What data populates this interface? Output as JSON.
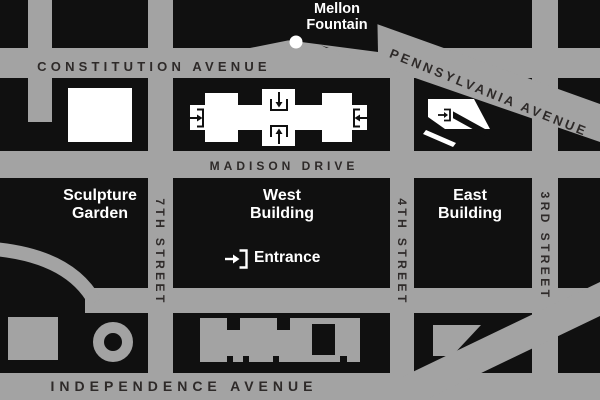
{
  "map_title": "National Gallery of Art area map",
  "streets": {
    "constitution": "CONSTITUTION AVENUE",
    "madison": "MADISON DRIVE",
    "pennsylvania": "PENNSYLVANIA AVENUE",
    "independence": "INDEPENDENCE AVENUE",
    "seventh": "7TH STREET",
    "fourth": "4TH STREET",
    "third": "3RD STREET"
  },
  "places": {
    "mellon": {
      "line1": "Mellon",
      "line2": "Fountain"
    },
    "sculpture": {
      "line1": "Sculpture",
      "line2": "Garden"
    },
    "west": {
      "line1": "West",
      "line2": "Building"
    },
    "east": {
      "line1": "East",
      "line2": "Building"
    }
  },
  "legend": {
    "entrance_label": "Entrance"
  },
  "colors": {
    "background": "#101010",
    "street_gray": "#a3a3a3",
    "building_white": "#ffffff",
    "street_text": "#2e2a29",
    "place_text": "#ffffff"
  }
}
